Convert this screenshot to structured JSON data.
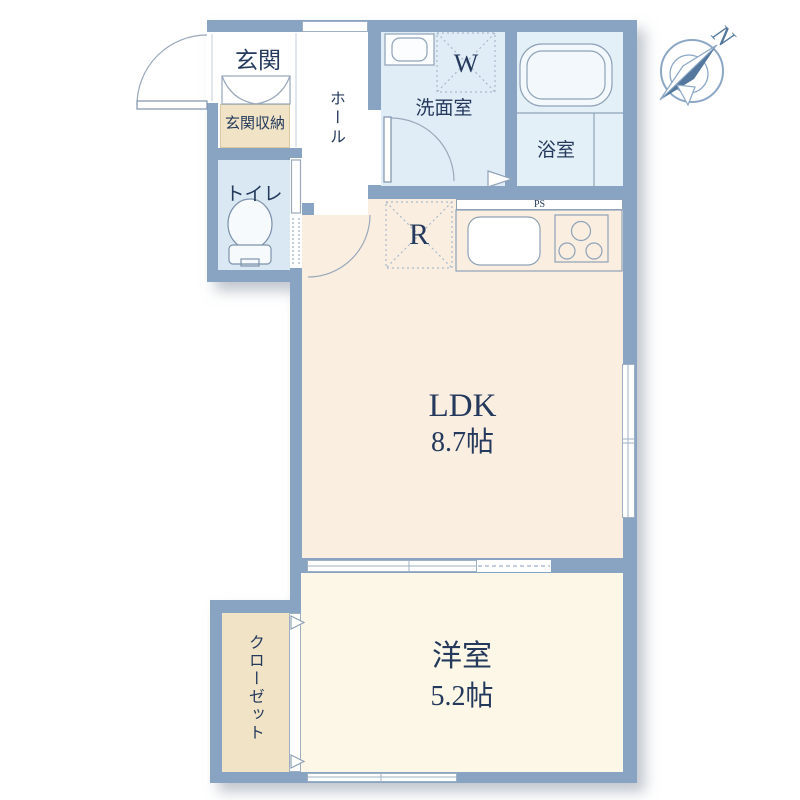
{
  "title": "1LDK apartment floor plan",
  "compass": {
    "north_label": "N"
  },
  "rooms": {
    "genkan": {
      "label": "玄関"
    },
    "genkan_storage": {
      "label": "玄関収納"
    },
    "toilet": {
      "label": "トイレ"
    },
    "hall": {
      "label": "ホール"
    },
    "washroom": {
      "label": "洗面室"
    },
    "washer_space": {
      "label": "W"
    },
    "bathroom": {
      "label": "浴室"
    },
    "refrigerator_space": {
      "label": "R"
    },
    "pipe_space": {
      "label": "PS"
    },
    "ldk": {
      "label": "LDK",
      "size": "8.7帖"
    },
    "western_room": {
      "label": "洋室",
      "size": "5.2帖"
    },
    "closet": {
      "label": "クローゼット"
    }
  },
  "colors": {
    "wall": "#89a4c2",
    "ldk_floor": "#faeee1",
    "western_room_floor": "#fcf7e6",
    "washroom_floor": "#e0edf6",
    "bathroom_floor": "#e4f0f8",
    "toilet_floor": "#d9e8f3",
    "storage_floor": "#f1e4c6",
    "hall_floor": "#ffffff",
    "label_text": "#24395c",
    "compass_needle": "#54779e"
  },
  "icons": {
    "compass": "compass-rose-icon",
    "bathtub": "bathtub-icon",
    "toilet": "toilet-icon",
    "washbasin": "washbasin-icon",
    "kitchen_sink": "kitchen-sink-icon",
    "stove": "three-burner-stove-icon",
    "door_arcs": "swing-door-icon",
    "sliding_door": "sliding-door-triangle-icon"
  }
}
